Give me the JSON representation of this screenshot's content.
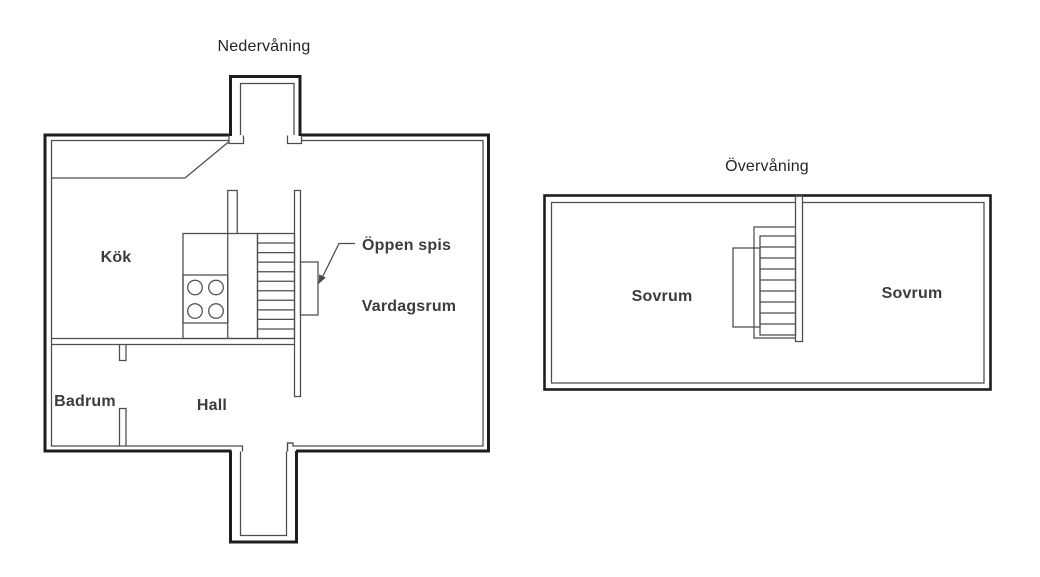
{
  "colors": {
    "background": "#ffffff",
    "wall": "#1d1d1d",
    "line": "#4c4c4c",
    "title_text": "#22242c",
    "label_text": "#3c3c3c"
  },
  "floors": [
    {
      "title": "Nedervåning",
      "rooms": [
        {
          "label": "Kök"
        },
        {
          "label": "Vardagsrum"
        },
        {
          "label": "Badrum"
        },
        {
          "label": "Hall"
        }
      ],
      "annotations": [
        {
          "label": "Öppen spis"
        }
      ],
      "fixtures": {
        "staircase_steps": 11,
        "stove_burners": 4,
        "entrances": 2
      }
    },
    {
      "title": "Övervåning",
      "rooms": [
        {
          "label": "Sovrum"
        },
        {
          "label": "Sovrum"
        }
      ],
      "fixtures": {
        "staircase_steps": 9
      }
    }
  ]
}
